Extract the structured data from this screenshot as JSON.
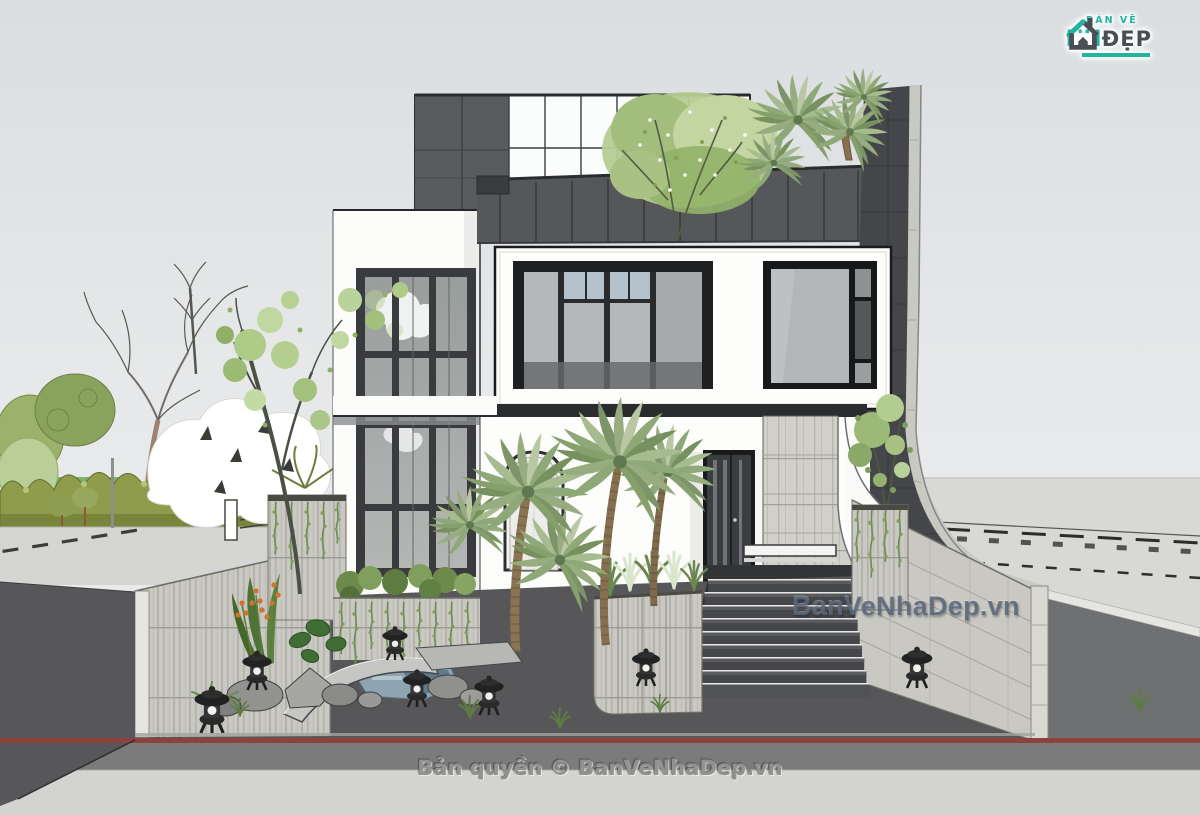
{
  "overlays": {
    "center_watermark": "BanVeNhaDep.vn",
    "bottom_copyright": "Bản quyền © BanVeNhaDep.vn"
  },
  "logo": {
    "top_text": "BẢN VẼ",
    "main_text": "NH",
    "right_text": "ĐẸP"
  },
  "scene": {
    "type": "3d-architectural-exterior-render",
    "subject": "Modern multi-storey white villa with dark panelled roof deck, rooftop palm garden, curved charcoal feature wall, stone planters and retaining walls, Japanese stone lanterns, rock-and-water garden and a wide entrance stair to the street",
    "palette": {
      "sky": "#e3e6e7",
      "facade_white": "#fcfcfb",
      "roof_panels": "#56575a",
      "charcoal_wall": "#45464a",
      "stone": "#c9c8c2",
      "glass": "#b2b4b2",
      "foliage_green": "#8ea878",
      "hedge_olive": "#8f9c4b",
      "courtyard": "#57575a",
      "road": "#7b7b7c",
      "curb_line_red": "#8e423c",
      "sidewalk": "#d3d3d1",
      "water": "#8da5b1",
      "logo_teal": "#22b3a1",
      "logo_dark": "#4a4f55"
    }
  }
}
